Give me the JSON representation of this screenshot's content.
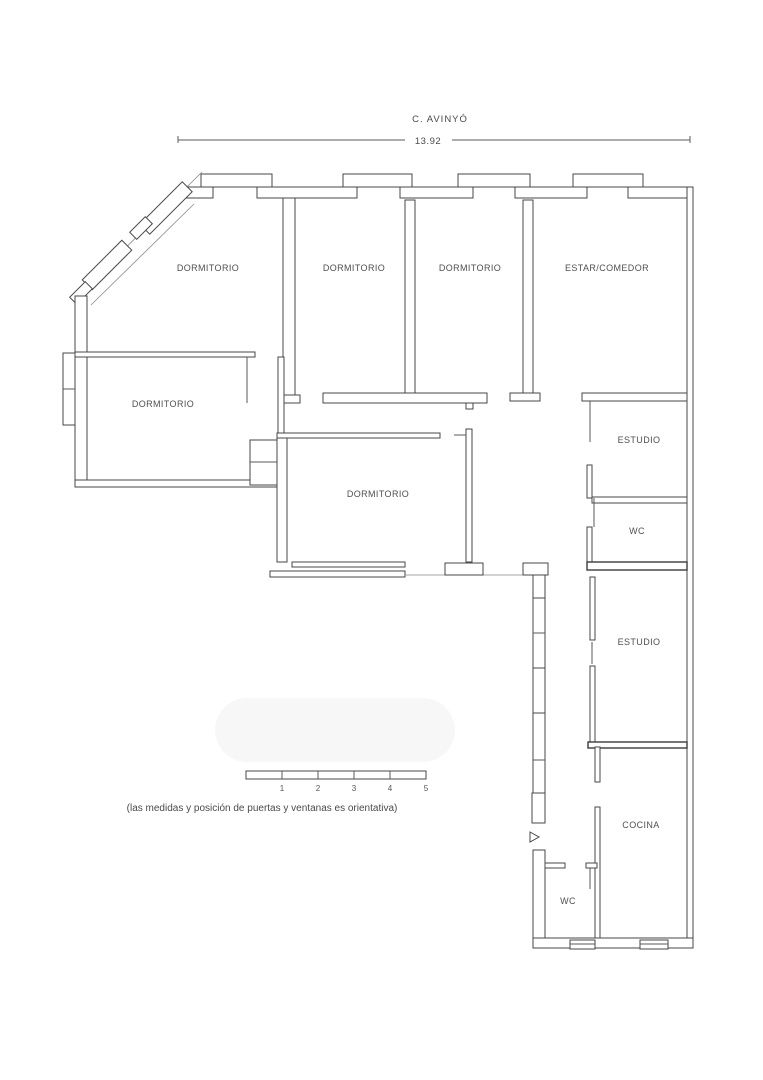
{
  "header": {
    "street_label": "C. AVINYÓ",
    "dimension": "13.92"
  },
  "rooms": {
    "dorm_top_left": "DORMITORIO",
    "dorm_top_2": "DORMITORIO",
    "dorm_top_3": "DORMITORIO",
    "estar_comedor": "ESTAR/COMEDOR",
    "dorm_left": "DORMITORIO",
    "dorm_center": "DORMITORIO",
    "estudio_1": "ESTUDIO",
    "wc_1": "WC",
    "estudio_2": "ESTUDIO",
    "cocina": "COCINA",
    "wc_2": "WC"
  },
  "scale_bar": {
    "labels": [
      "1",
      "2",
      "3",
      "4",
      "5"
    ]
  },
  "note": "(las medidas y posición de puertas y ventanas es orientativa)",
  "colors": {
    "line": "#474747",
    "text": "#4f4f4f",
    "watermark": "#f7f7f7"
  }
}
